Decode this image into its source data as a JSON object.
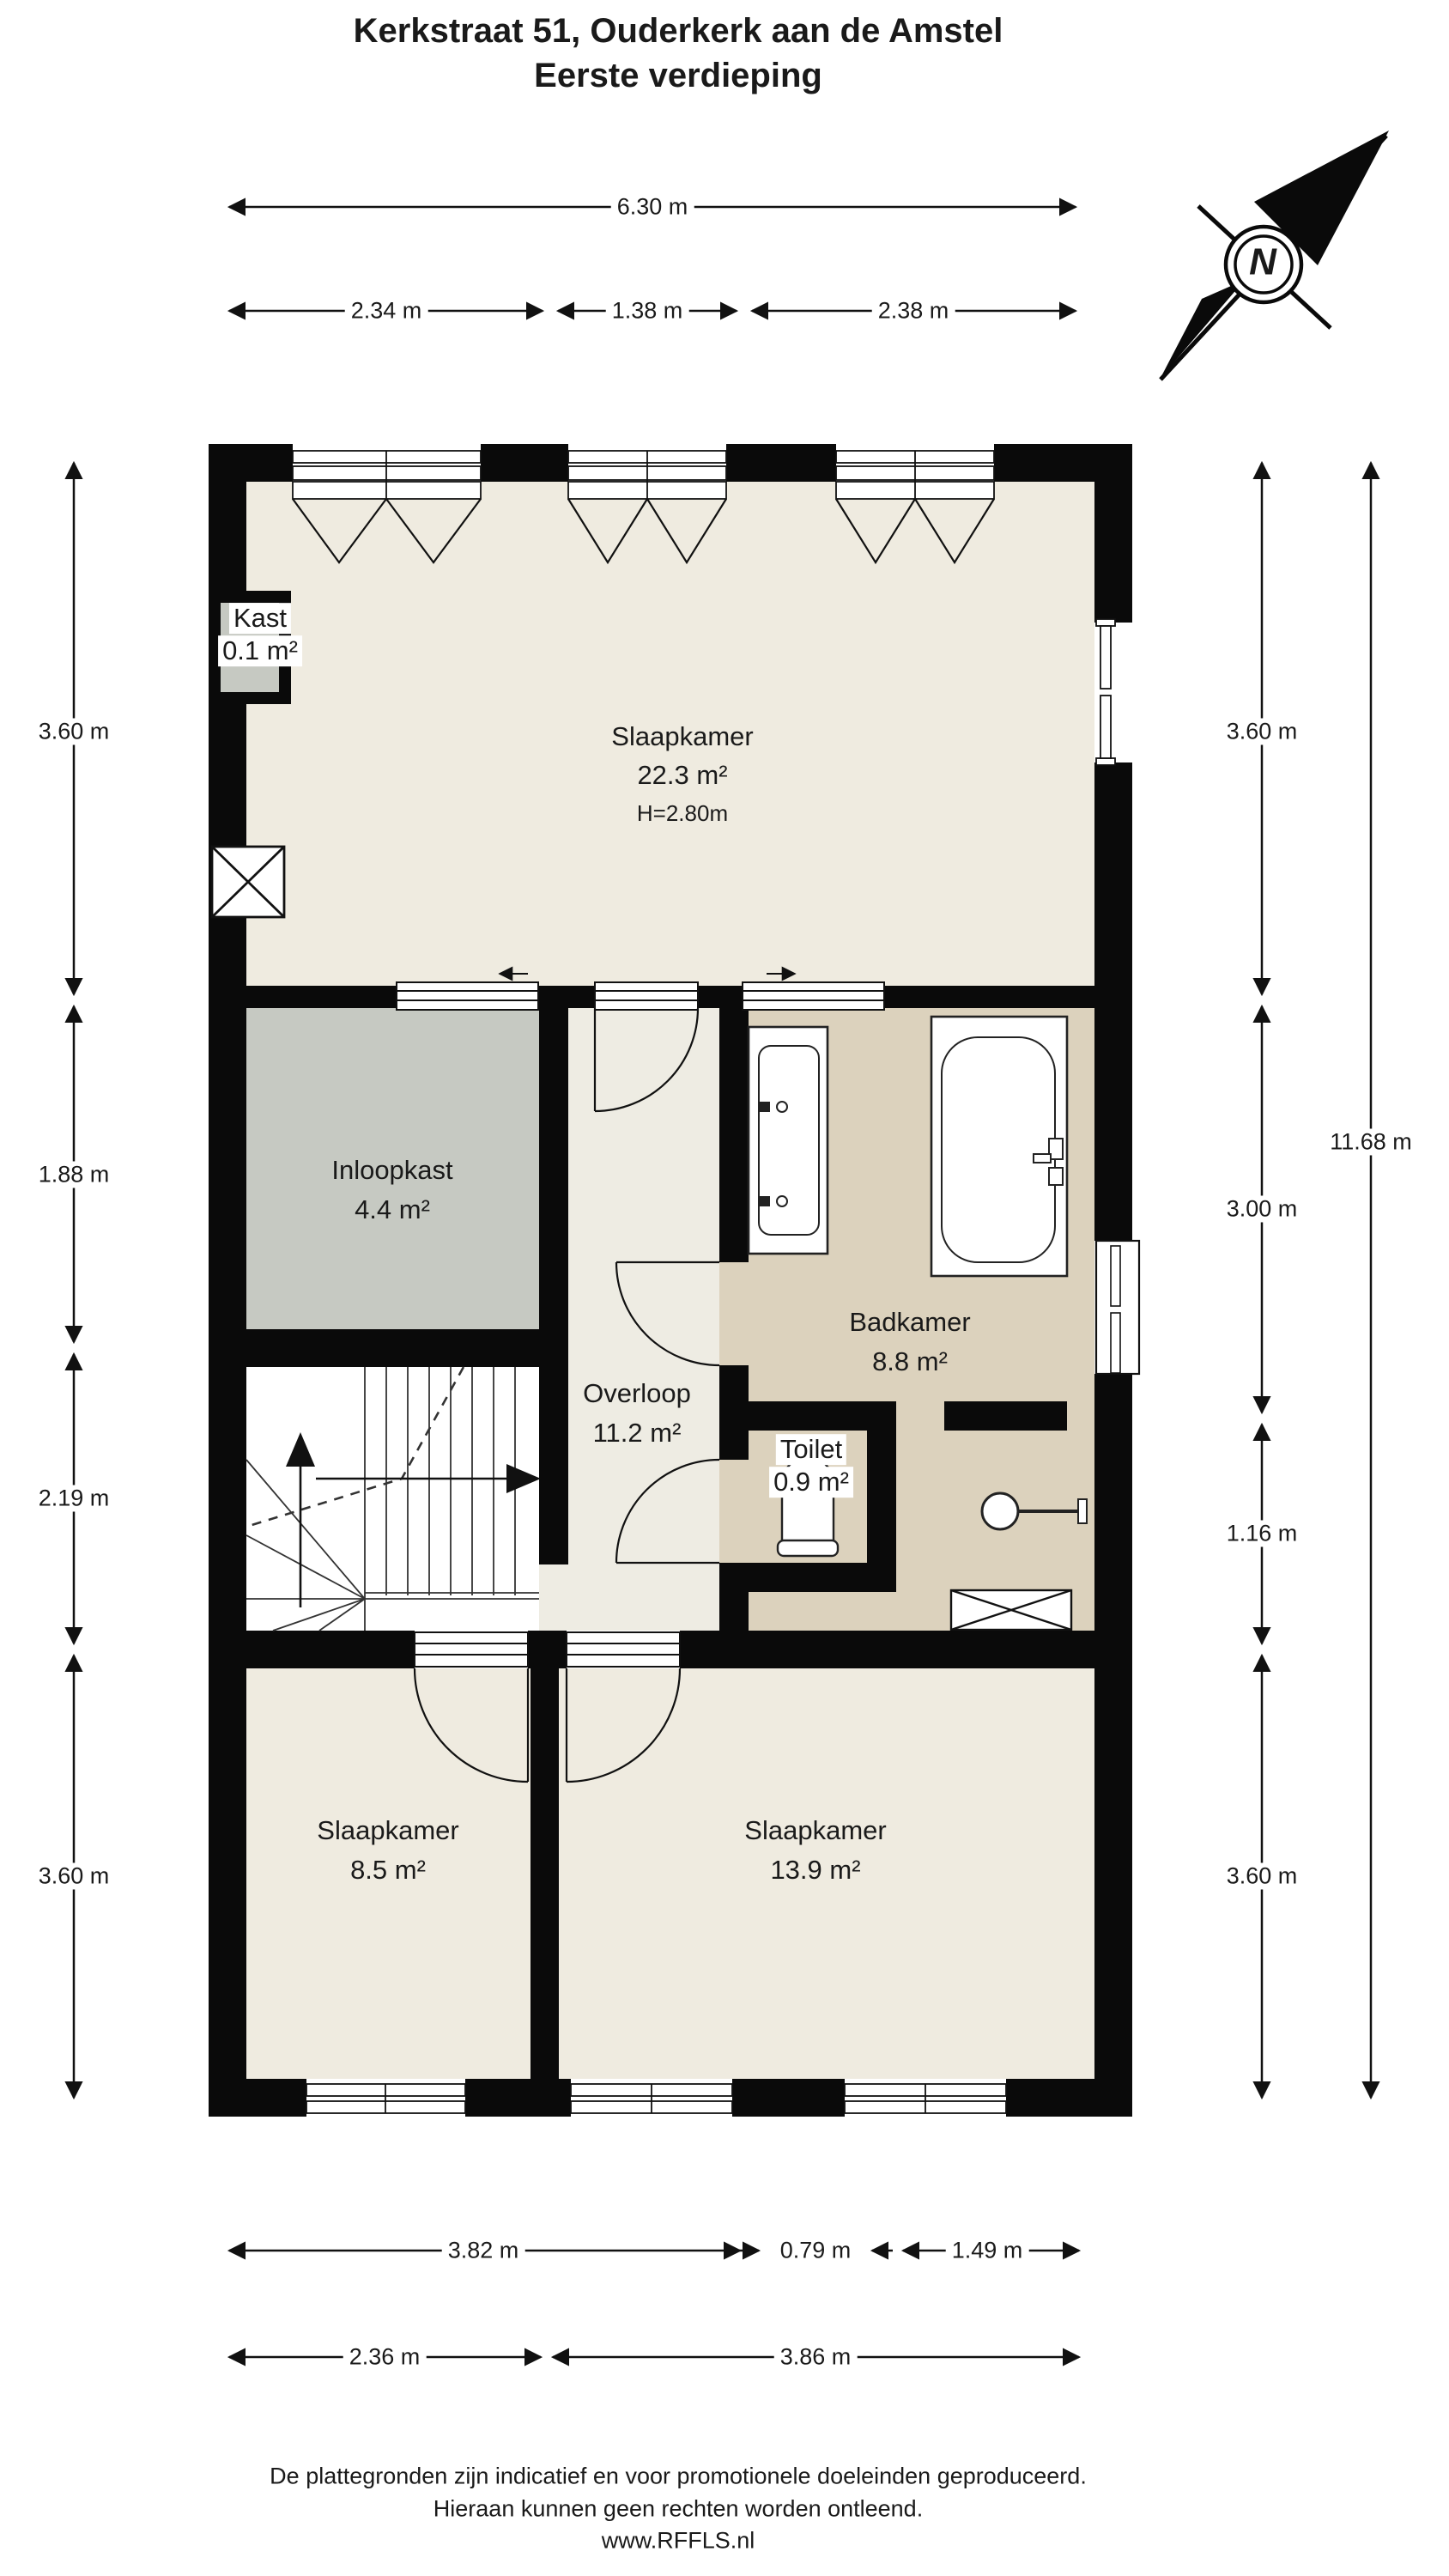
{
  "title": {
    "line1": "Kerkstraat 51, Ouderkerk aan de Amstel",
    "line2": "Eerste verdieping"
  },
  "compass": {
    "label": "N"
  },
  "dimensions": {
    "top_total": "6.30 m",
    "top_segments": [
      "2.34 m",
      "1.38 m",
      "2.38 m"
    ],
    "left": [
      "3.60 m",
      "1.88 m",
      "2.19 m",
      "3.60 m"
    ],
    "right": [
      "3.60 m",
      "3.00 m",
      "1.16 m",
      "3.60 m"
    ],
    "right_total": "11.68 m",
    "bottom_row1": [
      "3.82 m",
      "0.79 m",
      "1.49 m"
    ],
    "bottom_row2": [
      "2.36 m",
      "3.86 m"
    ]
  },
  "rooms": {
    "slaapkamer_1": {
      "name": "Slaapkamer",
      "area": "22.3 m²",
      "ceiling_height": "H=2.80m"
    },
    "kast": {
      "name": "Kast",
      "area": "0.1 m²"
    },
    "inloopkast": {
      "name": "Inloopkast",
      "area": "4.4 m²"
    },
    "overloop": {
      "name": "Overloop",
      "area": "11.2 m²"
    },
    "badkamer": {
      "name": "Badkamer",
      "area": "8.8 m²"
    },
    "toilet": {
      "name": "Toilet",
      "area": "0.9 m²"
    },
    "slaapkamer_2": {
      "name": "Slaapkamer",
      "area": "8.5 m²"
    },
    "slaapkamer_3": {
      "name": "Slaapkamer",
      "area": "13.9 m²"
    }
  },
  "footer": {
    "line1": "De plattegronden zijn indicatief en voor promotionele doeleinden geproduceerd.",
    "line2": "Hieraan kunnen geen rechten worden ontleend.",
    "line3": "www.RFFLS.nl"
  },
  "colors": {
    "wall": "#0a0a0a",
    "floor_bedroom": "#efebe0",
    "floor_hall": "#eeece3",
    "floor_bath": "#dcd2bd",
    "floor_closet": "#c6c9c2"
  }
}
